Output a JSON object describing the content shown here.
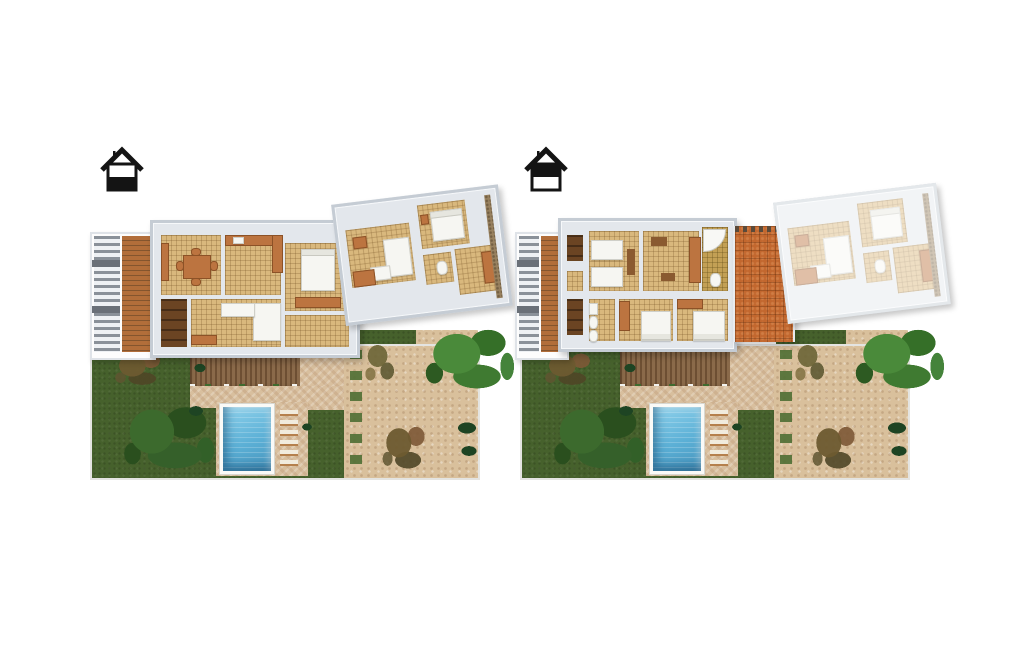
{
  "scene": {
    "name": "villa-floor-plan-renders",
    "background": "#ffffff",
    "view": "top-down-3d-render",
    "panel_count": 2
  },
  "panels": [
    {
      "name": "ground-floor-plan",
      "floor_icon": {
        "name": "house-ground-floor-icon",
        "filled_half": "bottom"
      },
      "building": {
        "rooms": [
          "pergola-deck",
          "dining-room",
          "kitchen",
          "bedroom",
          "pantry",
          "living-room",
          "hall",
          "wing-lounge",
          "wing-bedroom",
          "wing-bathroom",
          "wing-study"
        ]
      },
      "garden": {
        "features": [
          "lawn",
          "gravel-terrace",
          "wood-deck",
          "stone-patio",
          "swimming-pool",
          "sun-loungers",
          "large-tree",
          "brown-bush",
          "olive-tree",
          "bright-tree",
          "shrub-row",
          "dark-bushes"
        ]
      }
    },
    {
      "name": "first-floor-plan",
      "floor_icon": {
        "name": "house-first-floor-icon",
        "filled_half": "top"
      },
      "building": {
        "rooms": [
          "pergola-deck",
          "closet",
          "twin-bedroom",
          "wardrobe-bedroom",
          "bathroom-with-corner-tub",
          "bathroom",
          "double-bedroom-1",
          "double-bedroom-2",
          "roof-terrace",
          "ghosted-lower-wing"
        ]
      },
      "garden": {
        "features": [
          "lawn",
          "gravel-terrace",
          "wood-deck",
          "stone-patio",
          "swimming-pool",
          "sun-loungers",
          "large-tree",
          "brown-bush",
          "olive-tree",
          "bright-tree",
          "shrub-row",
          "dark-bushes"
        ]
      }
    }
  ],
  "colors": {
    "wall": "#e3e7ec",
    "wall_border": "#c5ccd4",
    "tile_floor": "#d9b87d",
    "wood_deck": "#b26e3a",
    "pergola": "#8a9199",
    "lawn": "#46612c",
    "gravel": "#d9c09c",
    "stone": "#d8bf9e",
    "terracotta": "#c2672e",
    "pool_water": "#5cb0d6",
    "orange_furniture": "#bc7440",
    "tree_green": "#35642a",
    "icon": "#141414"
  }
}
